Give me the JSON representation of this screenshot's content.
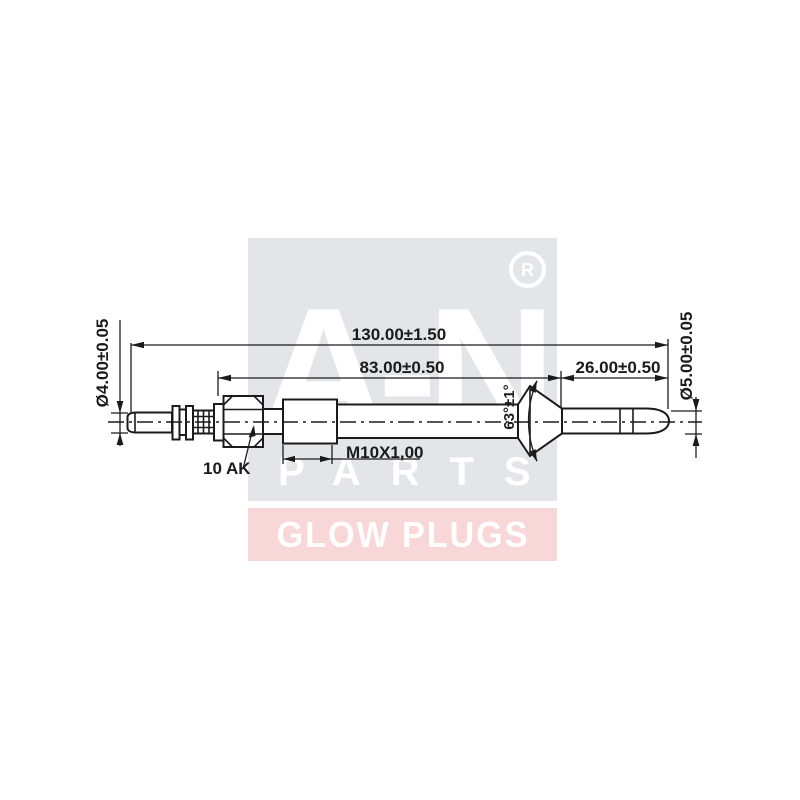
{
  "watermark": {
    "square_color": "#e3e5e9",
    "band_color": "#f8d7d9",
    "letter_color": "#ffffff",
    "brand_line1": "A-N",
    "brand_line2": "PARTS",
    "registered_mark": "R",
    "band_text": "GLOW PLUGS"
  },
  "drawing": {
    "line_color": "#1b1b1b",
    "dimensions": {
      "overall_length": "130.00±1.50",
      "body_length": "83.00±0.50",
      "probe_length": "26.00±0.50",
      "terminal_diameter": "Ø4.00±0.05",
      "probe_diameter": "Ø5.00±0.05",
      "thread_spec": "M10X1,00",
      "hex_label": "10 AK",
      "seat_angle": "63°±1°"
    }
  }
}
